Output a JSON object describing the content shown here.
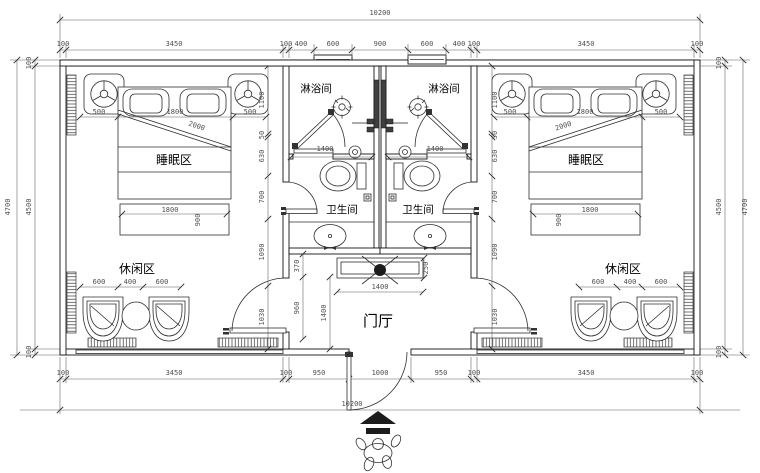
{
  "labels": {
    "shower_left": "淋浴间",
    "shower_right": "淋浴间",
    "sleep_left": "睡眠区",
    "sleep_right": "睡眠区",
    "wc_left": "卫生间",
    "wc_right": "卫生间",
    "leisure_left": "休闲区",
    "leisure_right": "休闲区",
    "foyer": "门厅"
  },
  "dims": {
    "top_total": "10200",
    "top_chain": [
      "100",
      "3450",
      "100",
      "400",
      "600",
      "900",
      "600",
      "400",
      "100",
      "3450",
      "100"
    ],
    "bottom_chain": [
      "100",
      "3450",
      "100",
      "950",
      "1000",
      "950",
      "100",
      "3450",
      "100"
    ],
    "bottom_total": "10200",
    "left_outer": "4700",
    "left_chain": [
      "100",
      "4500",
      "100"
    ],
    "right_chain": [
      "100",
      "4500",
      "100"
    ],
    "right_outer": "4700",
    "bath_left_width": "1400",
    "bath_right_width": "1400",
    "room_left": {
      "bed_top": [
        "500",
        "1800",
        "500"
      ],
      "bed_diag": "2000",
      "bed_foot_w": "1800",
      "bed_foot_d": "900",
      "side_chain": [
        "1100",
        "50",
        "630",
        "700",
        "1090",
        "1030"
      ],
      "leisure": [
        "600",
        "400",
        "600"
      ]
    },
    "room_right": {
      "bed_top": [
        "500",
        "1800",
        "500"
      ],
      "bed_diag": "2000",
      "bed_foot_w": "1800",
      "bed_foot_d": "900",
      "side_chain": [
        "1100",
        "50",
        "630",
        "700",
        "1090",
        "1030"
      ],
      "leisure": [
        "600",
        "400",
        "600"
      ]
    },
    "foyer": {
      "porch": "370",
      "hall": "960",
      "hall_depth": "1400",
      "cabinet_w": "1400",
      "cabinet_d": "250"
    }
  }
}
